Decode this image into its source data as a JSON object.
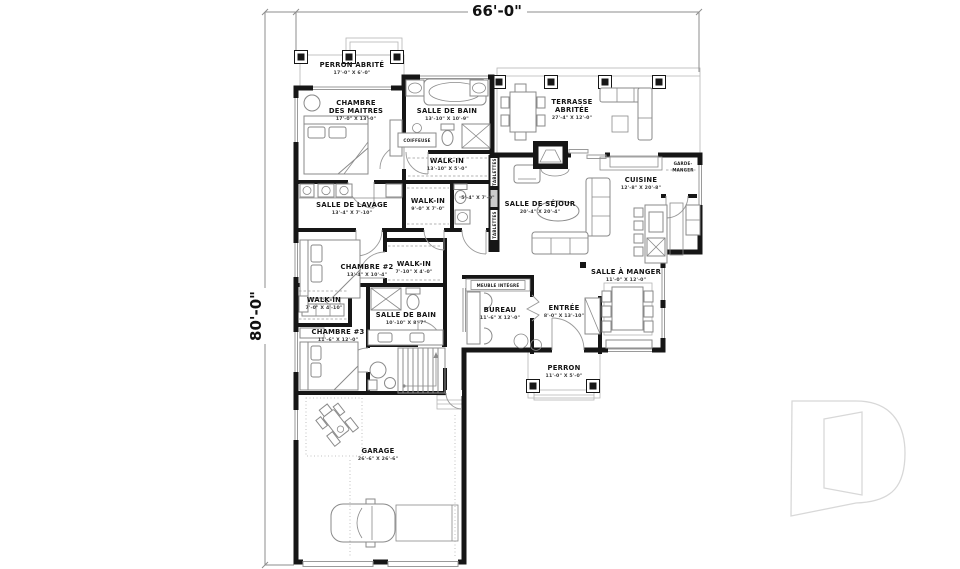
{
  "plan": {
    "overall_width": "66'-0\"",
    "overall_height": "80'-0\""
  },
  "rooms": {
    "perron_abrite": {
      "name": "PERRON ABRITÉ",
      "dims": "17'-0\" X 6'-0\""
    },
    "chambre_maitres": {
      "line1": "CHAMBRE",
      "line2": "DES MAITRES",
      "dims": "17'-0\" X 13'-0\""
    },
    "salle_de_bain_maitres": {
      "name": "SALLE DE BAIN",
      "dims": "13'-10\" X 10'-9\""
    },
    "walkin_maitres": {
      "name": "WALK-IN",
      "dims": "13'-10\" X 5'-0\""
    },
    "salle_de_lavage": {
      "name": "SALLE DE LAVAGE",
      "dims": "13'-4\" X 7'-10\""
    },
    "walkin_couloir": {
      "name": "WALK-IN",
      "dims": "9'-0\" X 7'-0\""
    },
    "toilette": {
      "dims": "5'-4\" X 7'-0\""
    },
    "chambre_2": {
      "name": "CHAMBRE #2",
      "dims": "13'-4\" X 10'-4\""
    },
    "walkin_chambre2": {
      "name": "WALK-IN",
      "dims": "7'-10\" X 4'-0\""
    },
    "walkin_chambre3": {
      "name": "WALK-IN",
      "dims": "7'-0\" X 4'-10\""
    },
    "salle_de_bain_2": {
      "name": "SALLE DE BAIN",
      "dims": "10'-10\" X 8'-7\""
    },
    "chambre_3": {
      "name": "CHAMBRE #3",
      "dims": "11'-6\" X 12'-0\""
    },
    "terrasse_abritee": {
      "line1": "TERRASSE",
      "line2": "ABRITÉE",
      "dims": "27'-4\" X 12'-0\""
    },
    "salle_de_sejour": {
      "name": "SALLE DE SÉJOUR",
      "dims": "20'-4\" X 20'-4\""
    },
    "cuisine": {
      "name": "CUISINE",
      "dims": "12'-8\" X 20'-8\""
    },
    "garde_manger": {
      "line1": "GARDE-",
      "line2": "MANGER"
    },
    "salle_a_manger": {
      "name": "SALLE À MANGER",
      "dims": "11'-0\" X 12'-0\""
    },
    "bureau": {
      "name": "BUREAU",
      "dims": "11'-6\" X 12'-0\""
    },
    "entree": {
      "name": "ENTRÉE",
      "dims": "8'-0\" X 13'-10\""
    },
    "perron": {
      "name": "PERRON",
      "dims": "11'-0\" X 5'-0\""
    },
    "garage": {
      "name": "GARAGE",
      "dims": "26'-6\" X 26'-6\""
    }
  },
  "annotations": {
    "coiffeuse": "COIFFEUSE",
    "tablettes": "TABLETTES",
    "meuble_integre": "MEUBLE INTÉGRÉ"
  },
  "colors": {
    "wall": "#161616",
    "furniture_line": "#8a8a8a",
    "watermark": "#d8d8d8"
  }
}
